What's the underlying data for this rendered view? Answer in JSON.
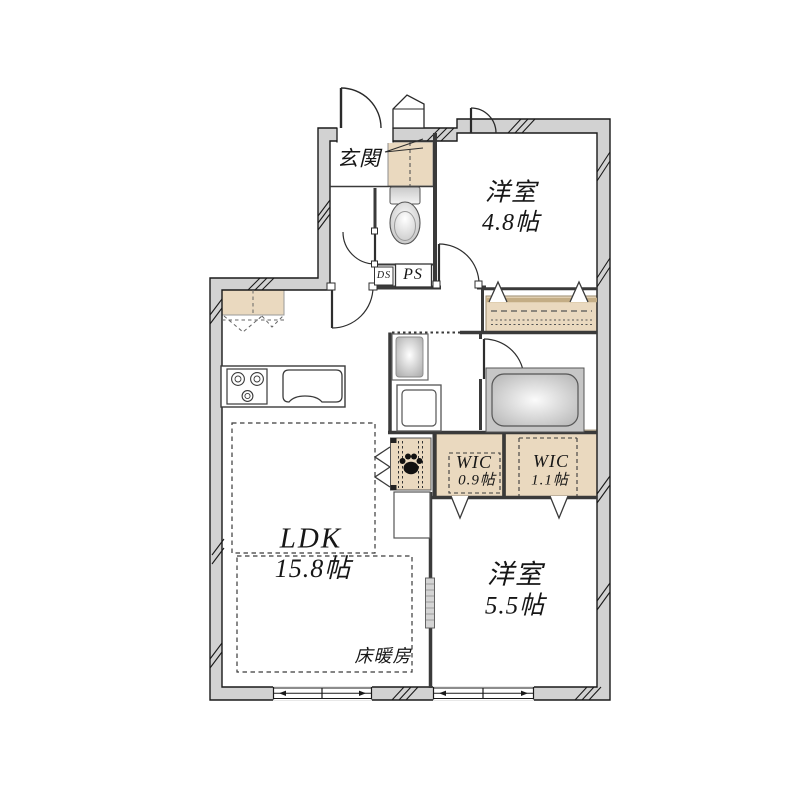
{
  "rooms": {
    "genkan": {
      "label": "玄関"
    },
    "western1": {
      "name": "洋室",
      "size": "4.8帖"
    },
    "western2": {
      "name": "洋室",
      "size": "5.5帖"
    },
    "ldk": {
      "name": "LDK",
      "size": "15.8帖"
    },
    "wic1": {
      "name": "WIC",
      "size": "0.9帖"
    },
    "wic2": {
      "name": "WIC",
      "size": "1.1帖"
    }
  },
  "annotations": {
    "floor_heating": "床暖房",
    "duct_shaft": "DS",
    "pipe_shaft": "PS"
  },
  "icons": {
    "pet_paw": "paw-icon"
  },
  "colors": {
    "background": "#ffffff",
    "wall_fill": "#d2d2d2",
    "wall_line": "#1a1a1a",
    "interior_line": "#3a3a3a",
    "fixture_beige": "#ead9bf",
    "tub_gray": "#c6c6c6",
    "text": "#161616"
  }
}
